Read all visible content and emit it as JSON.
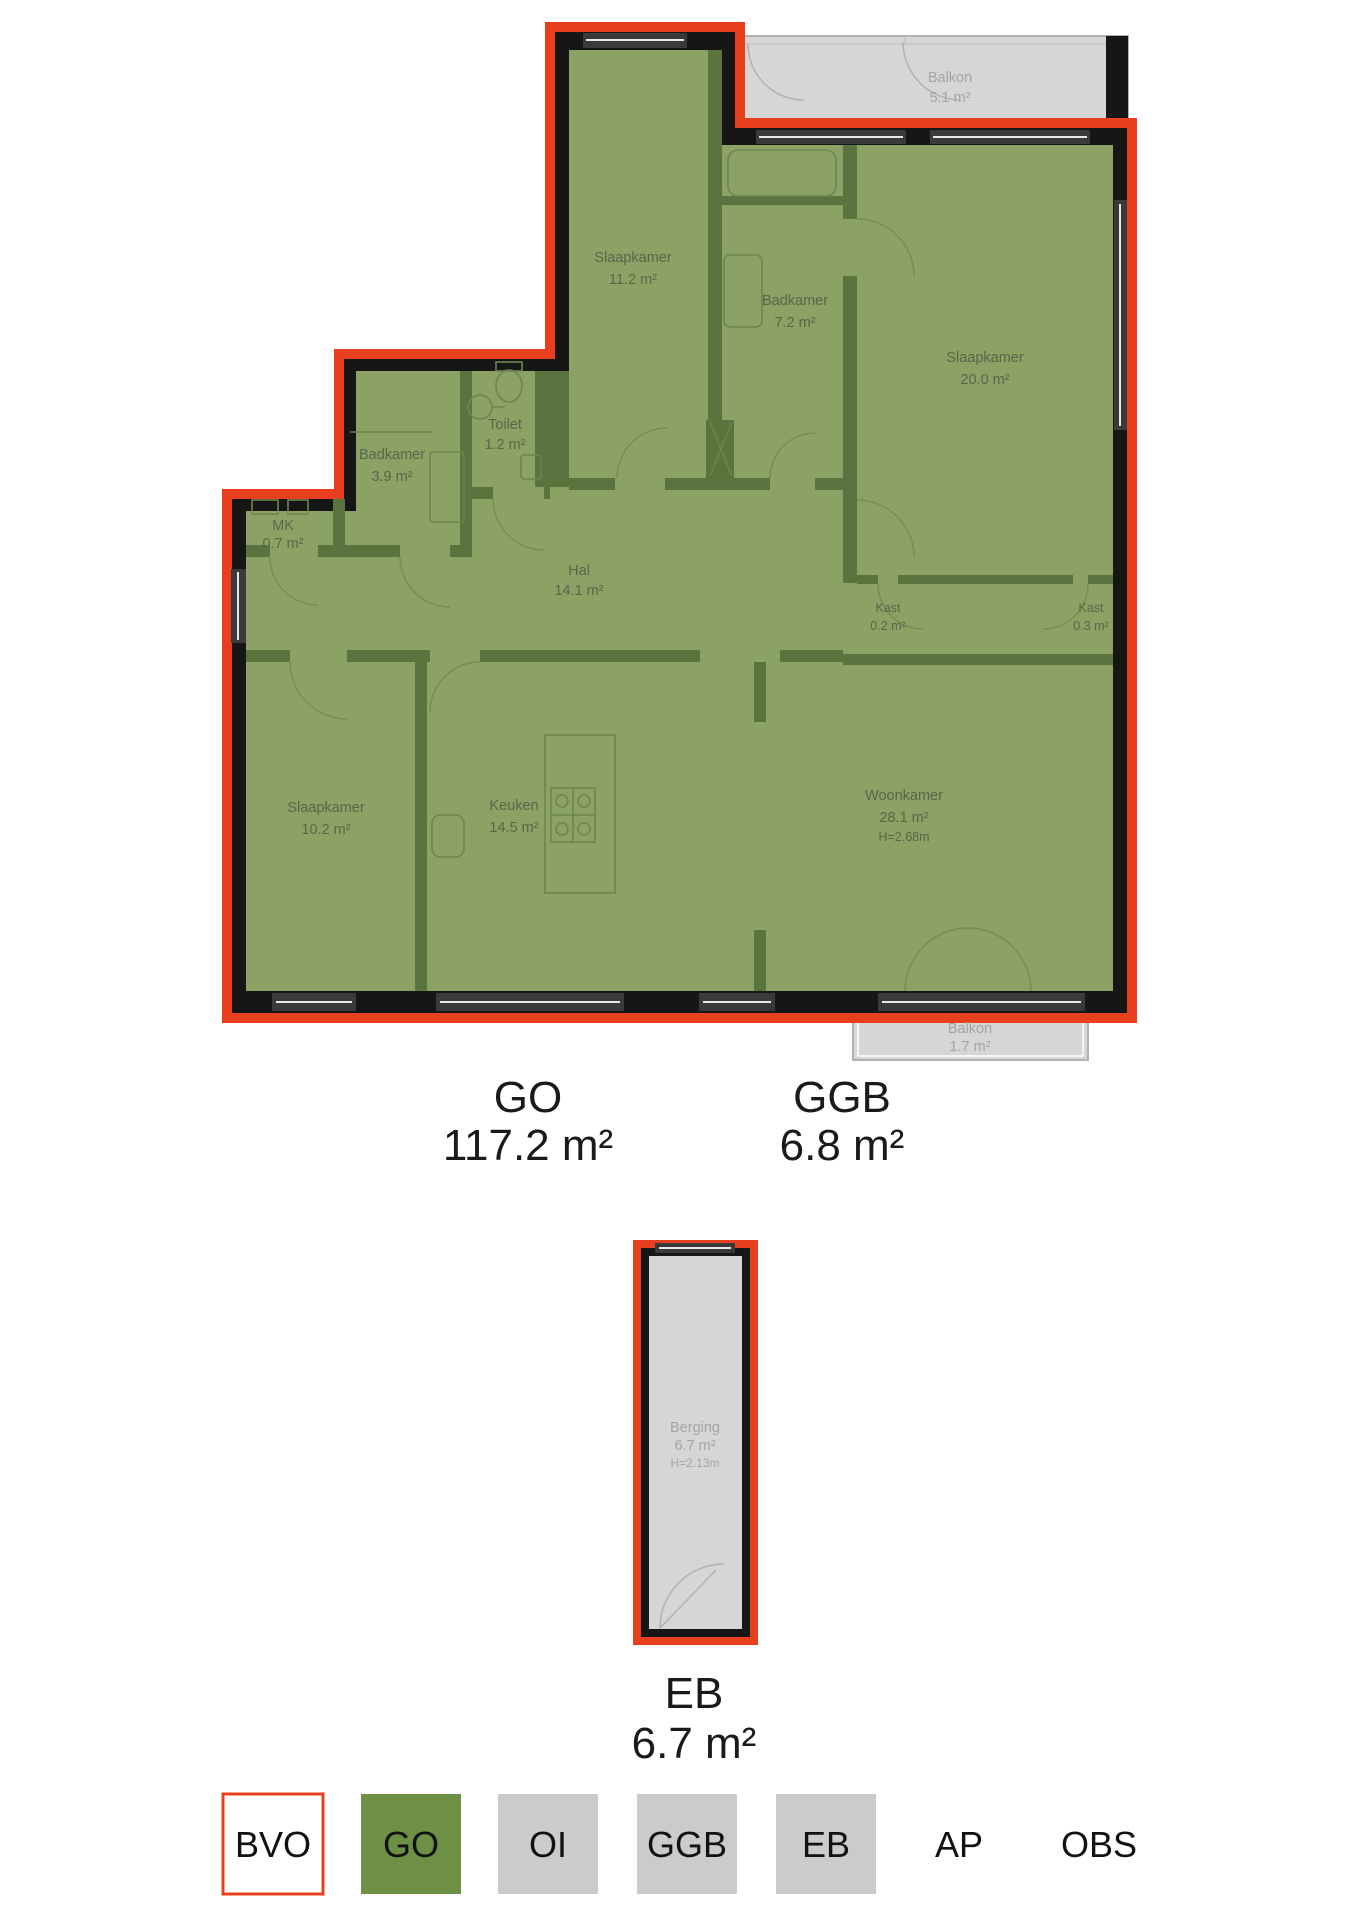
{
  "title": "Floor plan measurement drawing (NEN2580)",
  "colors": {
    "outline_red": "#e8401f",
    "wall_black": "#161616",
    "room_green": "#8ca265",
    "interior_wall_green": "#5a7440",
    "balcony_gray": "#d6d6d6",
    "legend_gray": "#cbcbcb",
    "legend_green": "#6d9044",
    "label_gray": "#a4a4a4",
    "room_label_green": "#57664a",
    "text_black": "#1a1a1a"
  },
  "rooms": [
    {
      "name": "Slaapkamer",
      "area": "11.2 m²"
    },
    {
      "name": "Badkamer",
      "area": "7.2 m²"
    },
    {
      "name": "Balkon",
      "area": "5.1 m²"
    },
    {
      "name": "Slaapkamer",
      "area": "20.0 m²"
    },
    {
      "name": "Badkamer",
      "area": "3.9 m²"
    },
    {
      "name": "Toilet",
      "area": "1.2 m²"
    },
    {
      "name": "MK",
      "area": "0.7 m²"
    },
    {
      "name": "Hal",
      "area": "14.1 m²"
    },
    {
      "name": "Kast",
      "area": "0.2 m²"
    },
    {
      "name": "Kast",
      "area": "0.3 m²"
    },
    {
      "name": "Slaapkamer",
      "area": "10.2 m²"
    },
    {
      "name": "Keuken",
      "area": "14.5 m²"
    },
    {
      "name": "Woonkamer",
      "area": "28.1 m²",
      "height": "H=2.68m"
    },
    {
      "name": "Balkon",
      "area": "1.7 m²"
    },
    {
      "name": "Berging",
      "area": "6.7 m²",
      "height": "H=2.13m"
    }
  ],
  "summary": {
    "go_label": "GO",
    "go_value": "117.2 m²",
    "ggb_label": "GGB",
    "ggb_value": "6.8 m²",
    "eb_label": "EB",
    "eb_value": "6.7 m²"
  },
  "legend": {
    "items": [
      {
        "label": "BVO",
        "fill": "#ffffff",
        "border": "#e8401f"
      },
      {
        "label": "GO",
        "fill": "#6d9044",
        "border": "none"
      },
      {
        "label": "OI",
        "fill": "#cbcbcb",
        "border": "none"
      },
      {
        "label": "GGB",
        "fill": "#cbcbcb",
        "border": "none"
      },
      {
        "label": "EB",
        "fill": "#cbcbcb",
        "border": "none"
      },
      {
        "label": "AP",
        "fill": "none",
        "border": "none"
      },
      {
        "label": "OBS",
        "fill": "none",
        "border": "none"
      }
    ]
  }
}
